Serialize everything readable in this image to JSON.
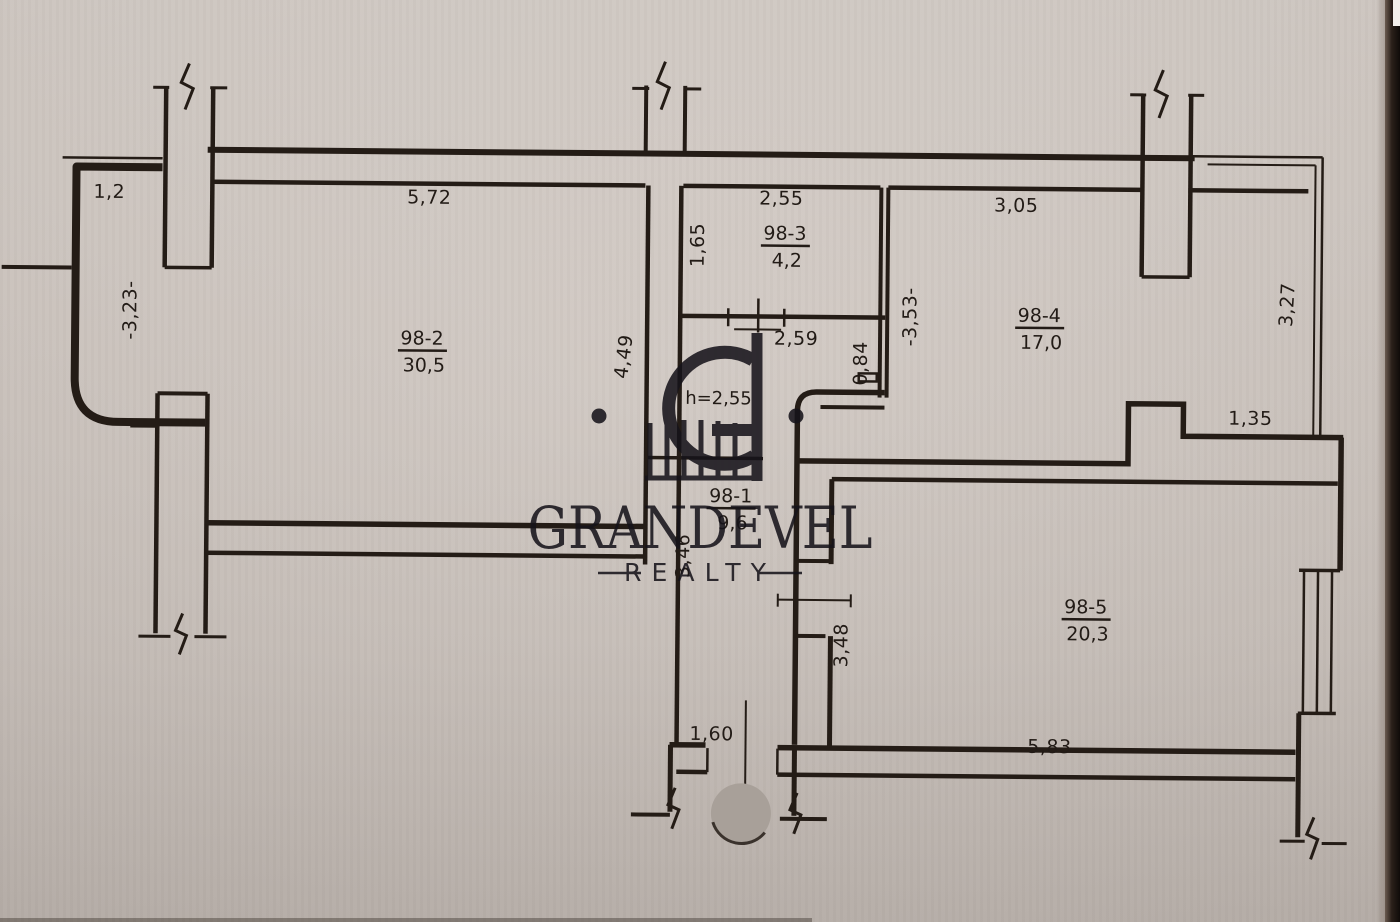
{
  "watermark": {
    "brand": "GRANDEVEL",
    "tagline": "REALTY",
    "logo": "grandevel-g-gate-monogram"
  },
  "rooms": {
    "r1": {
      "id": "98-1",
      "area": "9,6"
    },
    "r2": {
      "id": "98-2",
      "area": "30,5"
    },
    "r3": {
      "id": "98-3",
      "area": "4,2"
    },
    "r4": {
      "id": "98-4",
      "area": "17,0"
    },
    "r5": {
      "id": "98-5",
      "area": "20,3"
    }
  },
  "ceiling": {
    "height_note": "h=2,55"
  },
  "dims": {
    "balcony_left_w": "1,2",
    "balcony_left_d": "-3,23-",
    "r2_w": "5,72",
    "r3_w": "2,55",
    "r3_h": "1,65",
    "r4_w": "3,05",
    "r4_d": "-3,53-",
    "bath_w": "2,59",
    "bath_d": "0,84",
    "corridor_d": "4,49",
    "balcony_right_d": "3,27",
    "r4_notch": "1,35",
    "hall_len": "3,46",
    "r5_left": "3,48",
    "r5_w": "5,83",
    "entry_w": "1,60"
  }
}
